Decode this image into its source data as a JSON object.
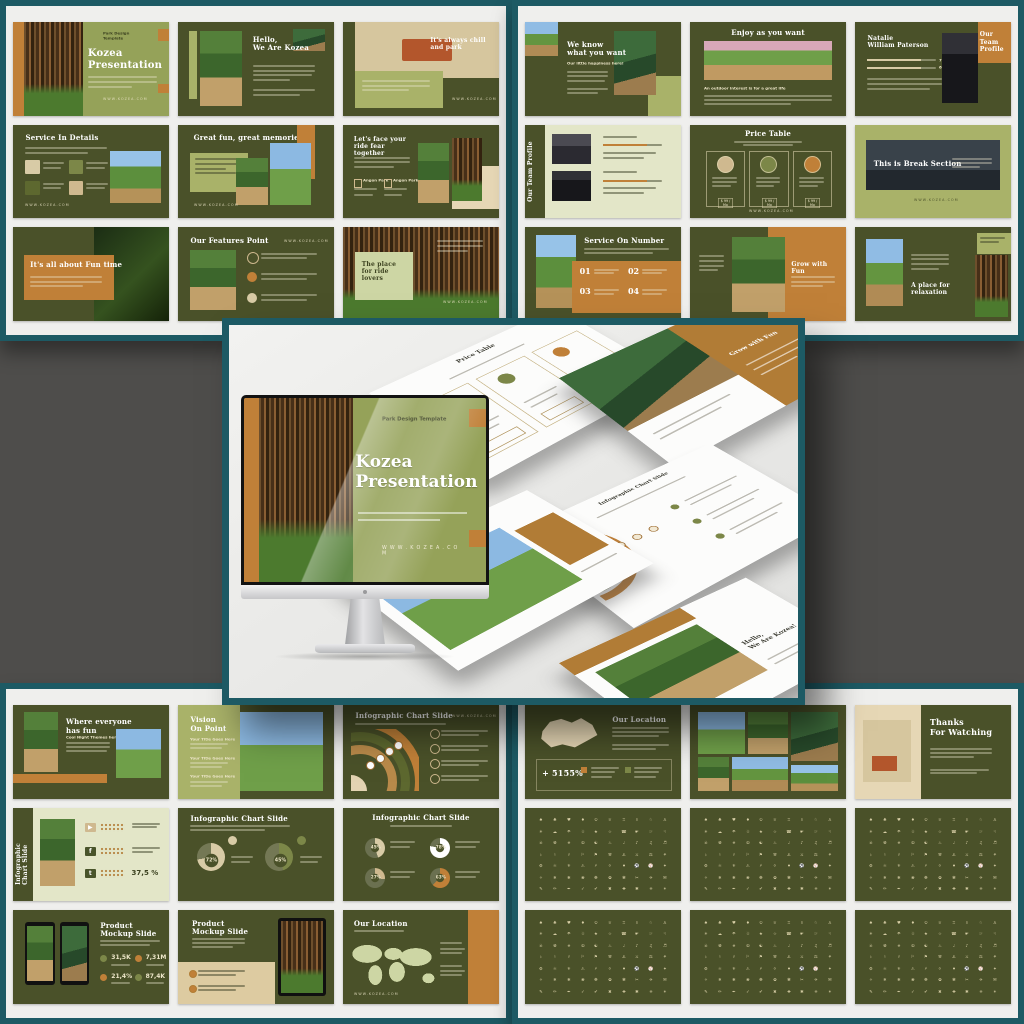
{
  "colors": {
    "teal_frame": "#1d5a64",
    "panel_bg": "#efefed",
    "band_gray": "#4e4d4b",
    "slide_green": "#4a5129",
    "sage": "#a9b269",
    "pale_green": "#e3e6c8",
    "ochre": "#c08038",
    "beige": "#e6d7b5",
    "cream_text": "#ece5c8"
  },
  "icon_glyphs": "♠♣♥♦♔♕♖♗♘♙☀☁☂☃★☆☎☛☞☟☠☢☣☮☯♨♩♪♫♬♭♮♯⚐⚑⚒⚓⚔⚖⚘⚙⚛⚜⚠⚡⚪⚫⚽⚾✦✧❄❅❀❁✿✾✂✈✉✎✏✒✓✔✖✚✱✳✴",
  "monitor": {
    "kicker": "Park Design Template",
    "title": "Kozea\nPresentation",
    "website": "W W W . K O Z E A . C O M"
  },
  "floating": [
    {
      "type": "price",
      "title": "Price Table",
      "btn": "$ 99 / Mo"
    },
    {
      "type": "grow",
      "title": "Grow with Fun"
    },
    {
      "type": "infographic",
      "title": "Infographic Chart Slide"
    },
    {
      "type": "memories",
      "title": "great memories"
    },
    {
      "type": "hello",
      "title": "Hello,\nWe Are Kozea!"
    }
  ],
  "panels": [
    {
      "id": "top-left",
      "slides": [
        {
          "type": "title",
          "kicker": "Park Design Template",
          "title": "Kozea\nPresentation",
          "footer": "WWW.KOZEA.COM"
        },
        {
          "type": "hello",
          "title": "Hello,\nWe Are Kozea"
        },
        {
          "type": "bench",
          "title": "It's always chill and park",
          "footer": "WWW.KOZEA.COM"
        },
        {
          "type": "services",
          "title": "Service In Details",
          "footer": "WWW.KOZEA.COM"
        },
        {
          "type": "memories",
          "title": "Great fun, great memories",
          "footer": "WWW.KOZEA.COM"
        },
        {
          "type": "ride",
          "title": "Let's face your\nride fear together",
          "items": [
            "Angon Park",
            "Angon Park"
          ]
        },
        {
          "type": "funtime",
          "title": "It's all about Fun time"
        },
        {
          "type": "features",
          "title": "Our Features Point",
          "footer": "WWW.KOZEA.COM"
        },
        {
          "type": "place",
          "title": "The place for ride\nlovers",
          "footer": "WWW.KOZEA.COM"
        }
      ]
    },
    {
      "id": "top-right",
      "slides": [
        {
          "type": "know",
          "title": "We know\nwhat you want",
          "subtitle": "Our little happiness here!"
        },
        {
          "type": "enjoy",
          "title": "Enjoy as you want",
          "caption": "An outdoor interest is for a great life"
        },
        {
          "type": "team",
          "title": "Our Team\nProfile",
          "name": "Natalie\nWilliam Paterson",
          "bars": [
            "75%",
            "60%"
          ]
        },
        {
          "type": "team2",
          "title": "Our Team Profile"
        },
        {
          "type": "price",
          "title": "Price Table",
          "btn": "$ 99 / Mo",
          "footer": "WWW.KOZEA.COM"
        },
        {
          "type": "break",
          "title": "This is Break Section",
          "footer": "WWW.KOZEA.COM"
        },
        {
          "type": "numbers",
          "title": "Service On Number",
          "numbers": [
            "01",
            "02",
            "03",
            "04"
          ]
        },
        {
          "type": "grow",
          "title": "Grow with Fun"
        },
        {
          "type": "relax",
          "title": "A place for relaxation"
        }
      ]
    },
    {
      "id": "bottom-left",
      "slides": [
        {
          "type": "everyone",
          "title": "Where everyone\nhas fun",
          "subtitle": "Cool Night Themes here"
        },
        {
          "type": "vision",
          "title": "Vision\nOn Point",
          "items": [
            "Your Title Goes Here",
            "Your Title Goes Here",
            "Your Title Goes Here"
          ]
        },
        {
          "type": "arc",
          "title": "Infographic Chart Slide",
          "footer": "WWW.KOZEA.COM"
        },
        {
          "type": "social",
          "title": "Infographic\nChart Slide",
          "value": "37,5 %",
          "icons": [
            "▶",
            "f",
            "t"
          ]
        },
        {
          "type": "donut",
          "title": "Infographic Chart Slide",
          "values": [
            "72%",
            "45%"
          ]
        },
        {
          "type": "gauge",
          "title": "Infographic Chart Slide",
          "values": [
            "45%",
            "78%",
            "27%",
            "63%"
          ]
        },
        {
          "type": "phones",
          "title": "Product\nMockup Slide",
          "stats": [
            "31,5K",
            "7,31M",
            "21,4%",
            "87,4K"
          ]
        },
        {
          "type": "tablet",
          "title": "Product\nMockup Slide"
        },
        {
          "type": "mapworld",
          "title": "Our Location",
          "footer": "WWW.KOZEA.COM"
        }
      ]
    },
    {
      "id": "bottom-right",
      "slides": [
        {
          "type": "mapch",
          "title": "Our Location",
          "stat": "+ 5155%"
        },
        {
          "type": "gallery"
        },
        {
          "type": "thanks",
          "title": "Thanks\nFor Watching"
        },
        {
          "type": "icons"
        },
        {
          "type": "icons"
        },
        {
          "type": "icons"
        },
        {
          "type": "icons"
        },
        {
          "type": "icons"
        },
        {
          "type": "icons"
        }
      ]
    }
  ]
}
